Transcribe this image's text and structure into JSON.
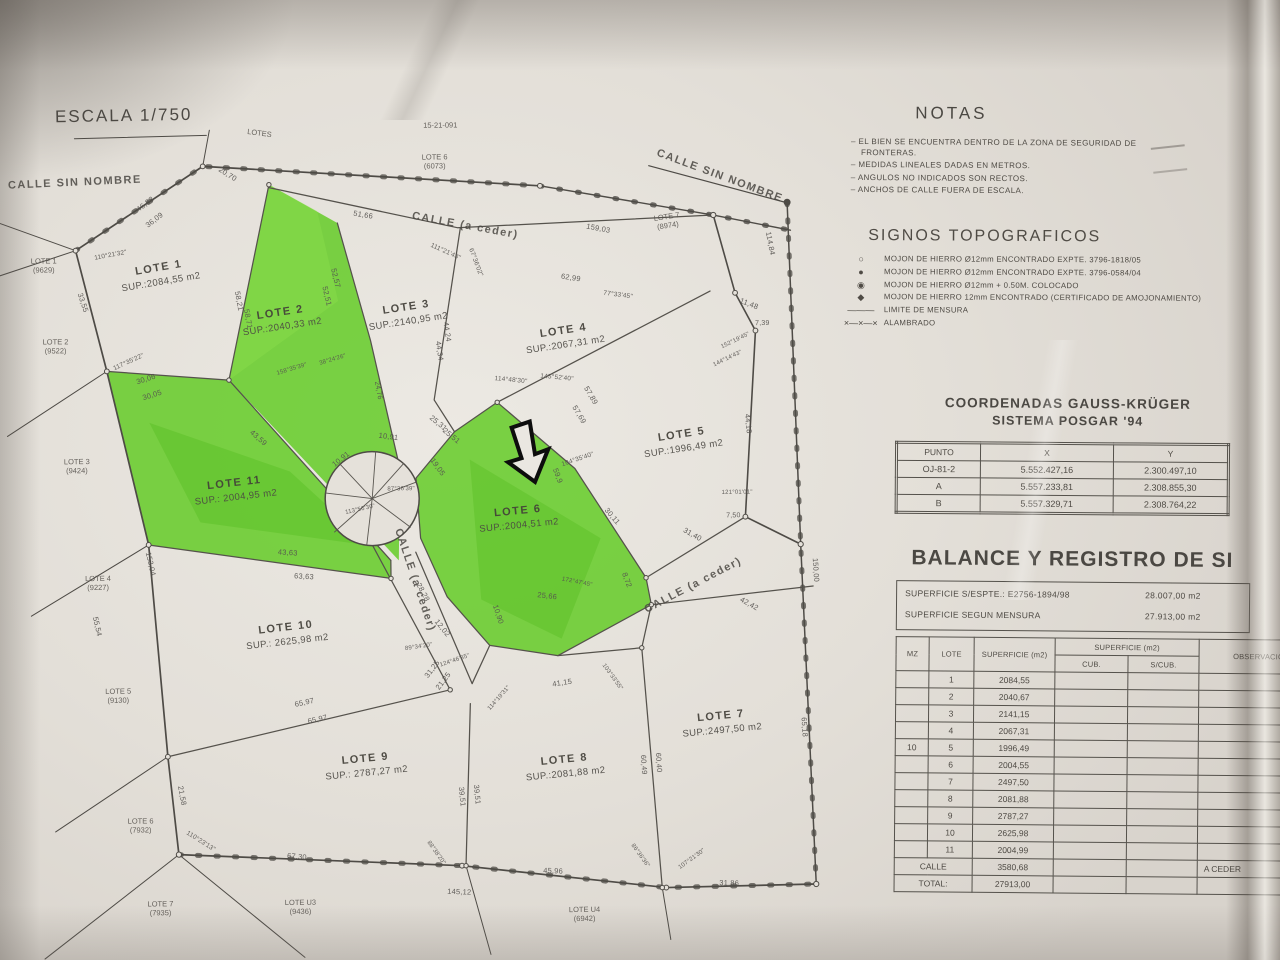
{
  "photo": {
    "scale_label": "ESCALA 1/750"
  },
  "notas": {
    "title": "NOTAS",
    "items": [
      "EL BIEN SE ENCUENTRA DENTRO DE LA ZONA DE SEGURIDAD DE FRONTERAS.",
      "MEDIDAS LINEALES DADAS EN METROS.",
      "ANGULOS NO INDICADOS SON RECTOS.",
      "ANCHOS DE CALLE FUERA DE ESCALA."
    ]
  },
  "signos": {
    "title": "SIGNOS TOPOGRAFICOS",
    "items": [
      {
        "sym": "○",
        "label": "MOJON DE HIERRO Ø12mm ENCONTRADO EXPTE. 3796-1818/05"
      },
      {
        "sym": "●",
        "label": "MOJON DE HIERRO Ø12mm ENCONTRADO EXPTE. 3796-0584/04"
      },
      {
        "sym": "◉",
        "label": "MOJON DE HIERRO Ø12mm + 0.50M. COLOCADO"
      },
      {
        "sym": "◆",
        "label": "MOJON DE HIERRO 12mm ENCONTRADO (CERTIFICADO DE AMOJONAMIENTO)"
      },
      {
        "sym": "———",
        "label": "LIMITE DE MENSURA"
      },
      {
        "sym": "×—×—×",
        "label": "ALAMBRADO"
      }
    ]
  },
  "coordenadas": {
    "title_line1": "COORDENADAS GAUSS-KRÜGER",
    "title_line2": "SISTEMA POSGAR '94",
    "headers": [
      "PUNTO",
      "X",
      "Y"
    ],
    "rows": [
      [
        "OJ-81-2",
        "5.552.427,16",
        "2.300.497,10"
      ],
      [
        "A",
        "5.557.233,81",
        "2.308.855,30"
      ],
      [
        "B",
        "5.557.329,71",
        "2.308.764,22"
      ]
    ]
  },
  "balance": {
    "title": "BALANCE Y REGISTRO DE SI",
    "sup_espte_label": "SUPERFICIE S/ESPTE.: E2756-1894/98",
    "sup_espte_value": "28.007,00 m2",
    "sup_mensura_label": "SUPERFICIE SEGUN MENSURA",
    "sup_mensura_value": "27.913,00 m2",
    "col_mz": "MZ",
    "col_lote": "LOTE",
    "col_sup": "SUPERFICIE (m2)",
    "col_sup_group": "SUPERFICIE (m2)",
    "col_cub": "CUB.",
    "col_scub": "S/CUB.",
    "col_obs": "OBSERVACIONES",
    "mz_value": "10",
    "rows": [
      [
        "1",
        "2084,55"
      ],
      [
        "2",
        "2040,67"
      ],
      [
        "3",
        "2141,15"
      ],
      [
        "4",
        "2067,31"
      ],
      [
        "5",
        "1996,49"
      ],
      [
        "6",
        "2004,55"
      ],
      [
        "7",
        "2497,50"
      ],
      [
        "8",
        "2081,88"
      ],
      [
        "9",
        "2787,27"
      ],
      [
        "10",
        "2625,98"
      ],
      [
        "11",
        "2004,99"
      ]
    ],
    "calle_label": "CALLE",
    "calle_value": "3580,68",
    "calle_obs": "A CEDER",
    "total_label": "TOTAL:",
    "total_value": "27913,00"
  },
  "map": {
    "lots": [
      {
        "name": "LOTE 1",
        "sup": "SUP.:2084,55 m2",
        "x": 162,
        "y": 272,
        "r": -9
      },
      {
        "name": "LOTE 2",
        "sup": "SUP.:2040,33 m2",
        "x": 283,
        "y": 318,
        "r": -8
      },
      {
        "name": "LOTE 3",
        "sup": "SUP.:2140,95 m2",
        "x": 409,
        "y": 314,
        "r": -8
      },
      {
        "name": "LOTE 4",
        "sup": "SUP.:2067,31 m2",
        "x": 566,
        "y": 339,
        "r": -8
      },
      {
        "name": "LOTE 5",
        "sup": "SUP.:1996,49 m2",
        "x": 683,
        "y": 444,
        "r": -8
      },
      {
        "name": "LOTE 6",
        "sup": "SUP.:2004,51 m2",
        "x": 518,
        "y": 519,
        "r": -5
      },
      {
        "name": "LOTE 7",
        "sup": "SUP.:2497,50 m2",
        "x": 719,
        "y": 726,
        "r": -5
      },
      {
        "name": "LOTE 8",
        "sup": "SUP.:2081,88 m2",
        "x": 562,
        "y": 768,
        "r": -5
      },
      {
        "name": "LOTE 9",
        "sup": "SUP.: 2787,27 m2",
        "x": 363,
        "y": 765,
        "r": -5
      },
      {
        "name": "LOTE 10",
        "sup": "SUP.: 2625,98 m2",
        "x": 285,
        "y": 633,
        "r": -6
      },
      {
        "name": "LOTE 11",
        "sup": "SUP.: 2004,95 m2",
        "x": 235,
        "y": 488,
        "r": -6
      }
    ],
    "neighbors": [
      {
        "name": "LOTE 1",
        "ref": "(9629)",
        "x": 46,
        "y": 262,
        "r": 0
      },
      {
        "name": "LOTE 2",
        "ref": "(9522)",
        "x": 57,
        "y": 343,
        "r": 0
      },
      {
        "name": "LOTE 3",
        "ref": "(9424)",
        "x": 77,
        "y": 463,
        "r": 0
      },
      {
        "name": "LOTE 4",
        "ref": "(9227)",
        "x": 97,
        "y": 580,
        "r": 0
      },
      {
        "name": "LOTE 5",
        "ref": "(9130)",
        "x": 116,
        "y": 693,
        "r": 0
      },
      {
        "name": "LOTE 6",
        "ref": "(7932)",
        "x": 137,
        "y": 823,
        "r": 0
      },
      {
        "name": "LOTE 7",
        "ref": "(7935)",
        "x": 156,
        "y": 906,
        "r": 0
      },
      {
        "name": "LOTE U3",
        "ref": "(9436)",
        "x": 296,
        "y": 906,
        "r": 0
      },
      {
        "name": "LOTE U4",
        "ref": "(6942)",
        "x": 580,
        "y": 916,
        "r": 0
      },
      {
        "name": "LOTE 6",
        "ref": "(6073)",
        "x": 438,
        "y": 162,
        "r": 0
      },
      {
        "name": "LOTE 7",
        "ref": "(8974)",
        "x": 670,
        "y": 224,
        "r": -8
      },
      {
        "name": "LOTES",
        "ref": "",
        "x": 263,
        "y": 132,
        "r": 8
      },
      {
        "name": "15-21-091",
        "ref": "",
        "x": 444,
        "y": 126,
        "r": 0
      }
    ],
    "streets": [
      {
        "t": "CALLE SIN NOMBRE",
        "x": 78,
        "y": 179,
        "r": -2
      },
      {
        "t": "CALLE (a ceder)",
        "x": 468,
        "y": 226,
        "r": 11
      },
      {
        "t": "CALLE SIN NOMBRE",
        "x": 723,
        "y": 179,
        "r": 21
      },
      {
        "t": "CALLE (a ceder)",
        "x": 414,
        "y": 580,
        "r": 72
      },
      {
        "t": "CALLE (a ceder)",
        "x": 692,
        "y": 588,
        "r": -27
      }
    ],
    "meas": [
      {
        "t": "46,83",
        "x": 148,
        "y": 201,
        "r": -37
      },
      {
        "t": "36,09",
        "x": 157,
        "y": 217,
        "r": -37
      },
      {
        "t": "20,70",
        "x": 231,
        "y": 172,
        "r": 33
      },
      {
        "t": "110°21'32\"",
        "x": 113,
        "y": 252,
        "r": -10,
        "s": 6.5
      },
      {
        "t": "33,55",
        "x": 85,
        "y": 299,
        "r": 72
      },
      {
        "t": "117°35'22\"",
        "x": 130,
        "y": 359,
        "r": -24,
        "s": 6.5
      },
      {
        "t": "30,06",
        "x": 147,
        "y": 376,
        "r": -17
      },
      {
        "t": "30,05",
        "x": 153,
        "y": 392,
        "r": -17
      },
      {
        "t": "51,66",
        "x": 366,
        "y": 214,
        "r": 10
      },
      {
        "t": "159,03",
        "x": 601,
        "y": 230,
        "r": 11
      },
      {
        "t": "62,99",
        "x": 573,
        "y": 279,
        "r": 9
      },
      {
        "t": "111°21'43\"",
        "x": 448,
        "y": 252,
        "r": 25,
        "s": 6.5
      },
      {
        "t": "67°36'02\"",
        "x": 478,
        "y": 263,
        "r": 70,
        "s": 6.5
      },
      {
        "t": "52,57",
        "x": 338,
        "y": 277,
        "r": 77
      },
      {
        "t": "52,51",
        "x": 329,
        "y": 295,
        "r": 77
      },
      {
        "t": "58,71",
        "x": 250,
        "y": 317,
        "r": 80
      },
      {
        "t": "58,21",
        "x": 241,
        "y": 299,
        "r": 80
      },
      {
        "t": "44,24",
        "x": 449,
        "y": 332,
        "r": 82
      },
      {
        "t": "44,34",
        "x": 441,
        "y": 351,
        "r": 82
      },
      {
        "t": "77°33'45\"",
        "x": 620,
        "y": 297,
        "r": 8,
        "s": 6.5
      },
      {
        "t": "11,48",
        "x": 751,
        "y": 307,
        "r": 22
      },
      {
        "t": "7,39",
        "x": 764,
        "y": 327,
        "r": 0,
        "s": 7
      },
      {
        "t": "152°19'45\"",
        "x": 737,
        "y": 344,
        "r": -25,
        "s": 6
      },
      {
        "t": "144°14'43\"",
        "x": 729,
        "y": 362,
        "r": -25,
        "s": 6
      },
      {
        "t": "114°48'30\"",
        "x": 512,
        "y": 381,
        "r": 6,
        "s": 6.5
      },
      {
        "t": "145°52'40\"",
        "x": 558,
        "y": 379,
        "r": 6,
        "s": 6.5
      },
      {
        "t": "158°35'39\"",
        "x": 293,
        "y": 368,
        "r": -16,
        "s": 6
      },
      {
        "t": "38°24'26\"",
        "x": 334,
        "y": 359,
        "r": -16,
        "s": 6
      },
      {
        "t": "24,76",
        "x": 379,
        "y": 390,
        "r": 80,
        "s": 7
      },
      {
        "t": "57,89",
        "x": 592,
        "y": 397,
        "r": 60
      },
      {
        "t": "57,69",
        "x": 580,
        "y": 416,
        "r": 60
      },
      {
        "t": "44,18",
        "x": 749,
        "y": 427,
        "r": 85
      },
      {
        "t": "104°35'40\"",
        "x": 578,
        "y": 461,
        "r": -18,
        "s": 6.5
      },
      {
        "t": "25,31",
        "x": 439,
        "y": 423,
        "r": 40
      },
      {
        "t": "25,51",
        "x": 452,
        "y": 436,
        "r": 40
      },
      {
        "t": "43,59",
        "x": 259,
        "y": 436,
        "r": 42
      },
      {
        "t": "10,91",
        "x": 389,
        "y": 436,
        "r": 8
      },
      {
        "t": "10,91",
        "x": 341,
        "y": 458,
        "r": -38
      },
      {
        "t": "19,05",
        "x": 438,
        "y": 467,
        "r": 55
      },
      {
        "t": "59,9",
        "x": 558,
        "y": 477,
        "r": 70
      },
      {
        "t": "30,11",
        "x": 612,
        "y": 518,
        "r": 50
      },
      {
        "t": "121°01'01\"",
        "x": 737,
        "y": 496,
        "r": 0,
        "s": 6
      },
      {
        "t": "7,50",
        "x": 733,
        "y": 519,
        "r": 0,
        "s": 7
      },
      {
        "t": "31,40",
        "x": 692,
        "y": 537,
        "r": 30
      },
      {
        "t": "150,00",
        "x": 815,
        "y": 574,
        "r": 87
      },
      {
        "t": "87°36'39\"",
        "x": 401,
        "y": 489,
        "r": 0,
        "s": 6
      },
      {
        "t": "113°56'30\"",
        "x": 360,
        "y": 509,
        "r": -12,
        "s": 6
      },
      {
        "t": "153,04",
        "x": 150,
        "y": 561,
        "r": 78
      },
      {
        "t": "43,63",
        "x": 287,
        "y": 551,
        "r": 4
      },
      {
        "t": "63,63",
        "x": 303,
        "y": 575,
        "r": 4
      },
      {
        "t": "55,54",
        "x": 96,
        "y": 623,
        "r": 78
      },
      {
        "t": "8,72",
        "x": 626,
        "y": 582,
        "r": 70
      },
      {
        "t": "25,66",
        "x": 546,
        "y": 597,
        "r": 7
      },
      {
        "t": "10,90",
        "x": 497,
        "y": 615,
        "r": 72
      },
      {
        "t": "12,02",
        "x": 441,
        "y": 628,
        "r": 52
      },
      {
        "t": "28,28",
        "x": 422,
        "y": 592,
        "r": 62
      },
      {
        "t": "42,42",
        "x": 748,
        "y": 607,
        "r": 30
      },
      {
        "t": "172°47'45\"",
        "x": 576,
        "y": 584,
        "r": 12,
        "s": 6
      },
      {
        "t": "89°34'20\"",
        "x": 417,
        "y": 647,
        "r": -8,
        "s": 6
      },
      {
        "t": "31,25",
        "x": 430,
        "y": 669,
        "r": -52
      },
      {
        "t": "21,25",
        "x": 441,
        "y": 681,
        "r": -52
      },
      {
        "t": "114°19'31\"",
        "x": 497,
        "y": 699,
        "r": -48,
        "s": 6
      },
      {
        "t": "124°46'35\"",
        "x": 453,
        "y": 661,
        "r": -18,
        "s": 6
      },
      {
        "t": "65,97",
        "x": 302,
        "y": 701,
        "r": -12
      },
      {
        "t": "65,97",
        "x": 315,
        "y": 718,
        "r": -12
      },
      {
        "t": "41,15",
        "x": 560,
        "y": 684,
        "r": -8
      },
      {
        "t": "103°33'55\"",
        "x": 610,
        "y": 679,
        "r": 55,
        "s": 6
      },
      {
        "t": "39,51",
        "x": 459,
        "y": 797,
        "r": 85
      },
      {
        "t": "39,51",
        "x": 474,
        "y": 795,
        "r": 85
      },
      {
        "t": "60,49",
        "x": 641,
        "y": 767,
        "r": 87
      },
      {
        "t": "60,40",
        "x": 656,
        "y": 765,
        "r": 87
      },
      {
        "t": "65,18",
        "x": 802,
        "y": 731,
        "r": 87
      },
      {
        "t": "21,58",
        "x": 179,
        "y": 793,
        "r": 80
      },
      {
        "t": "110°23'13\"",
        "x": 197,
        "y": 839,
        "r": 33,
        "s": 6.5
      },
      {
        "t": "67,30",
        "x": 293,
        "y": 855,
        "r": 6
      },
      {
        "t": "45,96",
        "x": 549,
        "y": 872,
        "r": 3
      },
      {
        "t": "145,12",
        "x": 455,
        "y": 892,
        "r": 3
      },
      {
        "t": "31,86",
        "x": 725,
        "y": 886,
        "r": 2
      },
      {
        "t": "86°36'36\"",
        "x": 636,
        "y": 858,
        "r": 55,
        "s": 6
      },
      {
        "t": "107°21'30\"",
        "x": 688,
        "y": 862,
        "r": -35,
        "s": 6
      },
      {
        "t": "88°38'20\"",
        "x": 432,
        "y": 853,
        "r": 55,
        "s": 6
      },
      {
        "t": "114,84",
        "x": 773,
        "y": 247,
        "r": 80
      }
    ]
  }
}
